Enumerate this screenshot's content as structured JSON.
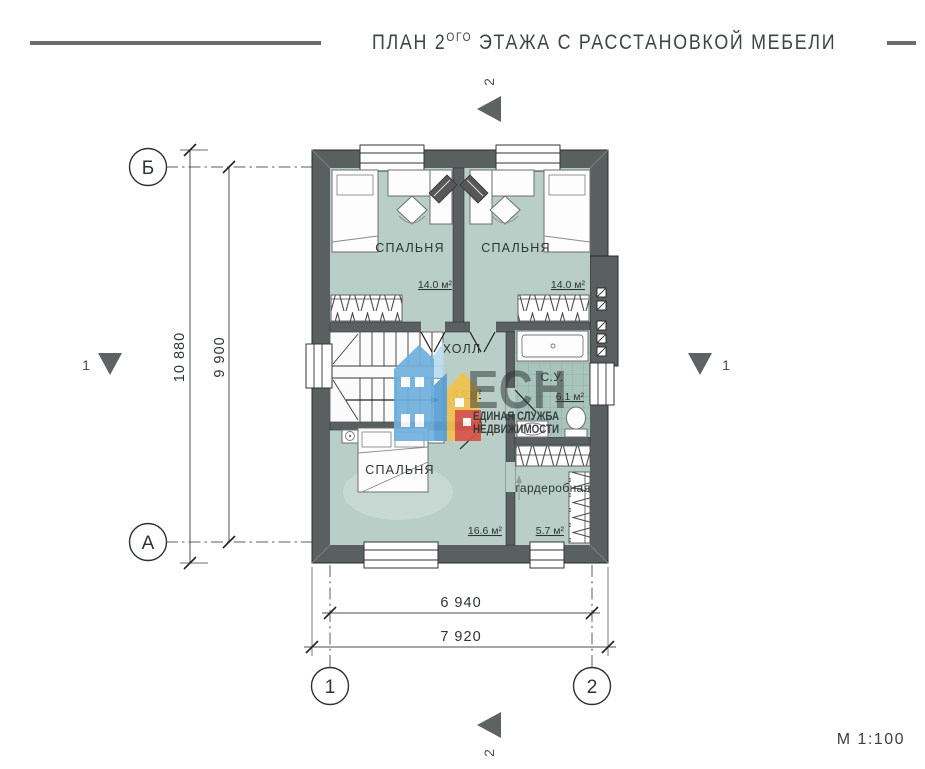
{
  "title": {
    "prefix": "ПЛАН 2",
    "superscript": "ОГО",
    "suffix": " ЭТАЖА С РАССТАНОВКОЙ МЕБЕЛИ"
  },
  "scale_label": "М 1:100",
  "axes": {
    "row_top": "Б",
    "row_bottom": "А",
    "col_left": "1",
    "col_right": "2"
  },
  "sections": {
    "top": "2",
    "bottom": "2",
    "left": "1",
    "right": "1"
  },
  "dimensions": {
    "total_height": "10 880",
    "inner_height": "9 900",
    "inner_width": "6 940",
    "total_width": "7 920"
  },
  "rooms": {
    "bedroom_top_left": {
      "name": "СПАЛЬНЯ",
      "area": "14.0 м²"
    },
    "bedroom_top_right": {
      "name": "СПАЛЬНЯ",
      "area": "14.0 м²"
    },
    "hall": {
      "name": "ХОЛЛ",
      "area": "4.0 м²"
    },
    "bathroom": {
      "name": "С.У.",
      "area": "6.1 м²"
    },
    "bedroom_bottom": {
      "name": "СПАЛЬНЯ",
      "area": "16.6 м²"
    },
    "wardrobe": {
      "name": "гардеробная",
      "area": "5.7 м²"
    }
  },
  "watermark": {
    "abbr": "ЕСН",
    "tagline1": "ЕДИНАЯ СЛУЖБА",
    "tagline2": "НЕДВИЖИМОСТИ"
  },
  "colors": {
    "wall": "#5a6060",
    "floor": "#b8cec6",
    "rug": "#c7d9d2",
    "accent_blue": "#6fb0dd",
    "accent_blue_dark": "#5a9fd4",
    "accent_lightblue": "#b9dcf2",
    "accent_yellow": "#f2c24d",
    "accent_red": "#da5247",
    "wm_gray": "#94a19c",
    "wm_green": "#83a096"
  }
}
